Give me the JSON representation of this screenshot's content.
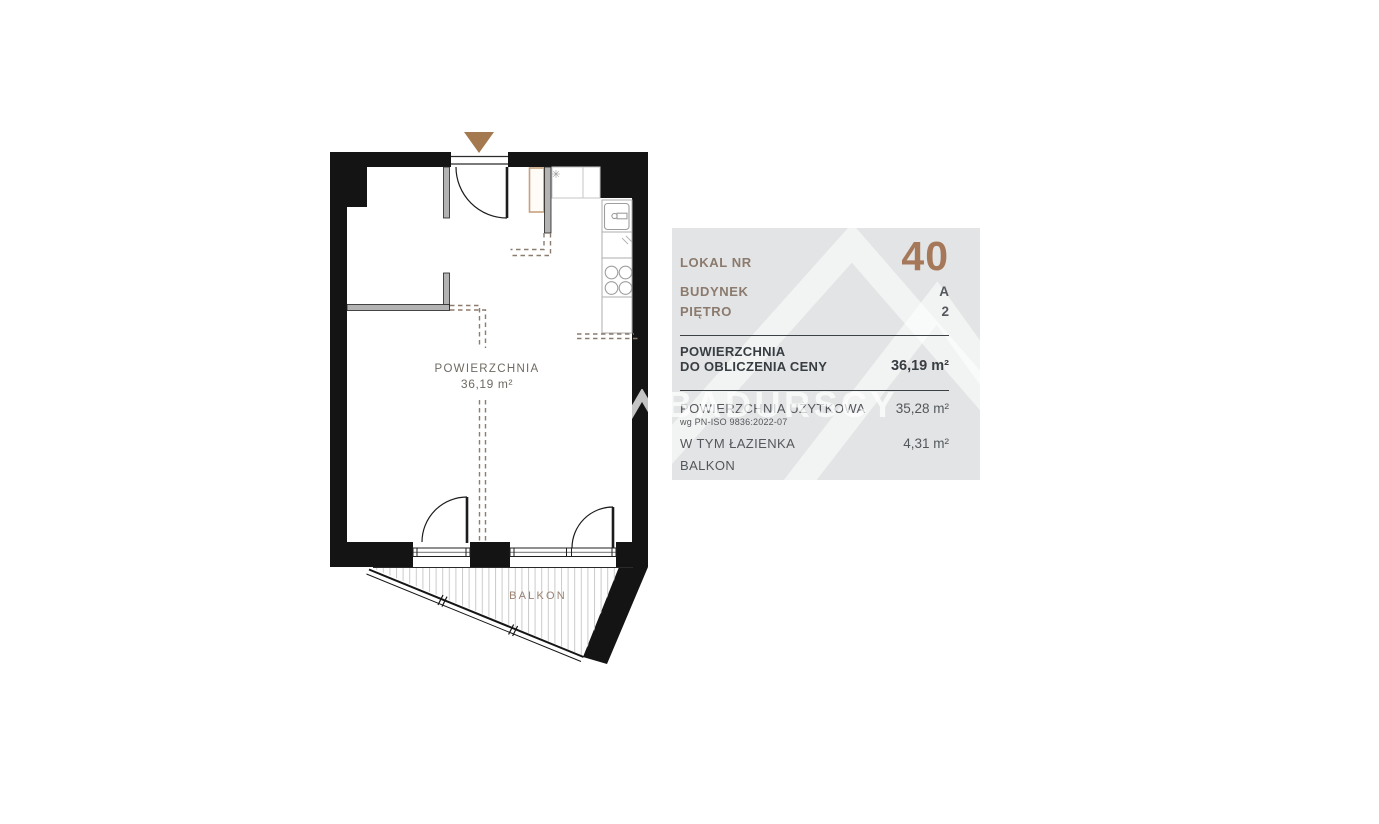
{
  "watermark": {
    "brand": "BADURSCY"
  },
  "floor_plan": {
    "area_title": "POWIERZCHNIA",
    "area_value": "36,19 m²",
    "balcony_label": "BALKON",
    "asterisk_marker": "✳"
  },
  "info_panel": {
    "unit": {
      "label": "LOKAL NR",
      "value": "40"
    },
    "building": {
      "label": "BUDYNEK",
      "value": "A"
    },
    "floor": {
      "label": "PIĘTRO",
      "value": "2"
    },
    "price_area": {
      "label_line1": "POWIERZCHNIA",
      "label_line2": "DO OBLICZENIA CENY",
      "value": "36,19 m²"
    },
    "usable_area": {
      "label": "POWIERZCHNIA UŻYTKOWA",
      "note": "wg PN-ISO 9836:2022-07",
      "value": "35,28 m²"
    },
    "bathroom": {
      "label": "W TYM ŁAZIENKA",
      "value": "4,31 m²"
    },
    "balcony": {
      "label": "BALKON",
      "value": ""
    }
  },
  "colors": {
    "accent_brown": "#a6785a",
    "label_brown": "#8b7a6d",
    "panel_background": "#e3e4e5",
    "wall_black": "#141414",
    "partition_gray": "#b3b3b3",
    "dashed_line": "#8b7c6f",
    "plan_text": "#6f6a63",
    "balcony_text": "#9a8271",
    "entrance_arrow": "#a5794f"
  }
}
